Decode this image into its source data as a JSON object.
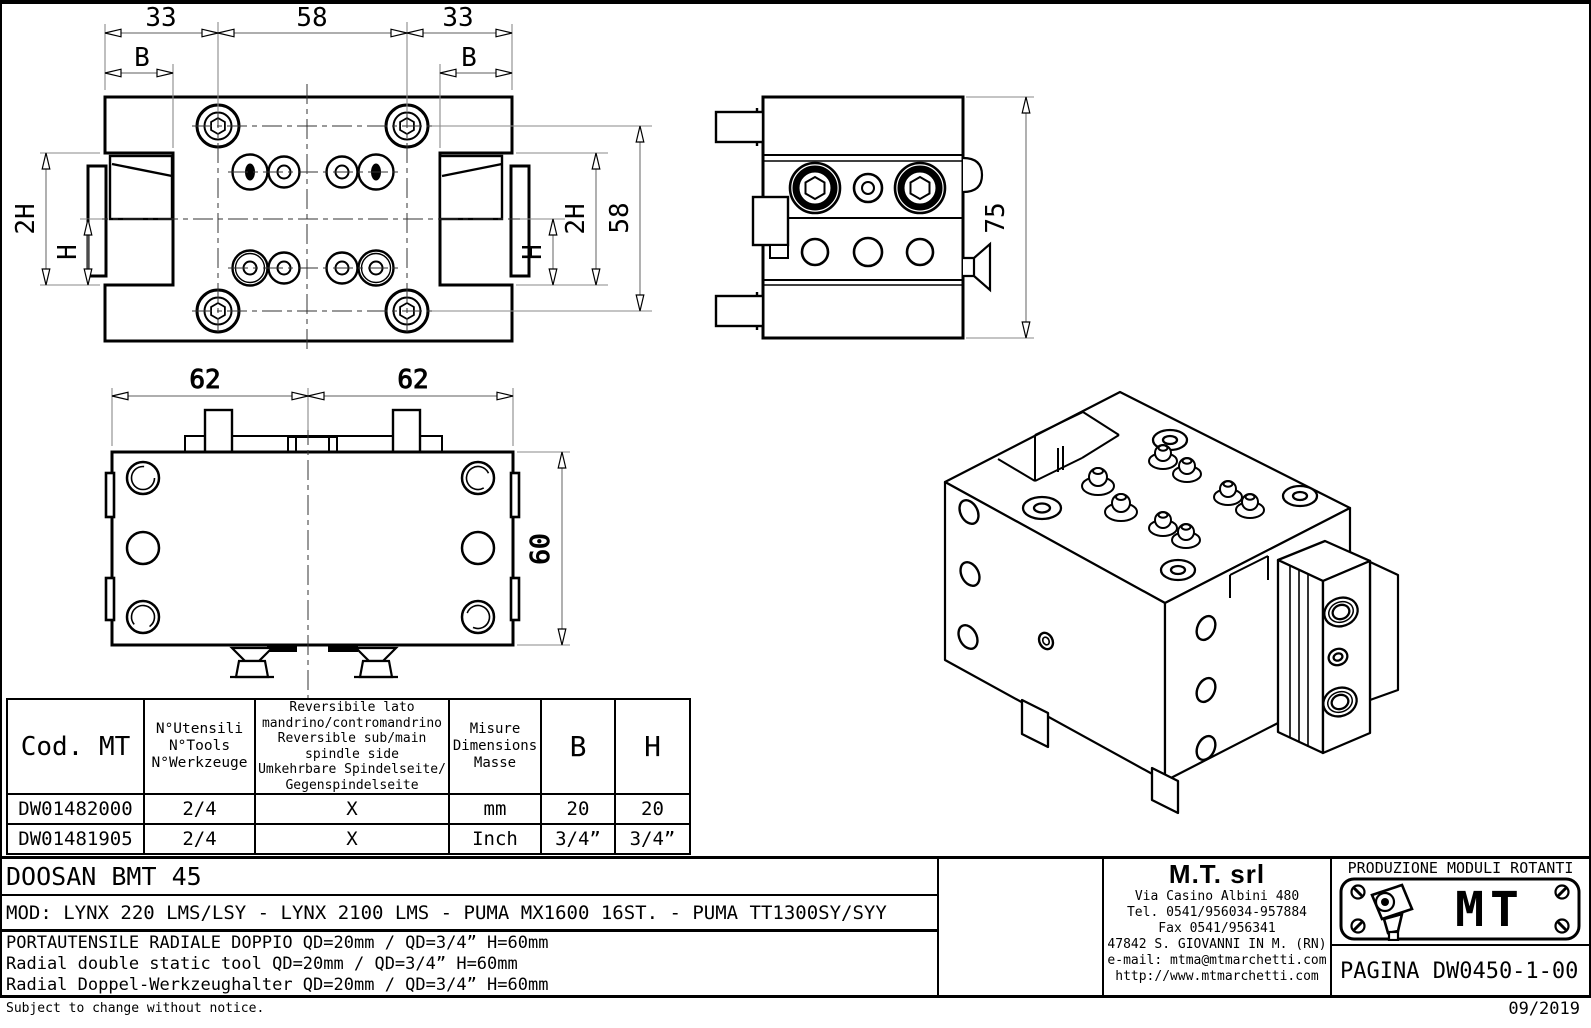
{
  "colors": {
    "line": "#000000",
    "dimension_line": "#8a8a8a",
    "background": "#ffffff"
  },
  "drawing": {
    "dims": {
      "top_33_left": "33",
      "top_58": "58",
      "top_33_right": "33",
      "b_left": "B",
      "b_right": "B",
      "left_2h": "2H",
      "left_h": "H",
      "right_h": "H",
      "right_2h": "2H",
      "right_58": "58",
      "side_75": "75",
      "front_62_left": "62",
      "front_62_right": "62",
      "front_60": "60"
    }
  },
  "table": {
    "header_cod": "Cod. MT",
    "header_tools": "N°Utensili\nN°Tools\nN°Werkzeuge",
    "header_reversible": "Reversibile lato\nmandrino/contromandrino\nReversible sub/main\nspindle side\nUmkehrbare Spindelseite/\nGegenspindelseite",
    "header_measure": "Misure\nDimensions\nMasse",
    "header_b": "B",
    "header_h": "H",
    "rows": [
      {
        "cod": "DW01482000",
        "tools": "2/4",
        "rev": "X",
        "measure": "mm",
        "b": "20",
        "h": "20"
      },
      {
        "cod": "DW01481905",
        "tools": "2/4",
        "rev": "X",
        "measure": "Inch",
        "b": "3/4”",
        "h": "3/4”"
      }
    ]
  },
  "title_block": {
    "model_name": "DOOSAN BMT 45",
    "mod_line": "MOD: LYNX 220 LMS/LSY - LYNX 2100 LMS - PUMA MX1600 16ST. - PUMA TT1300SY/SYY",
    "desc_it": "PORTAUTENSILE RADIALE DOPPIO QD=20mm / QD=3/4” H=60mm",
    "desc_en": "Radial double static tool QD=20mm / QD=3/4” H=60mm",
    "desc_de": "Radial Doppel-Werkzeughalter QD=20mm / QD=3/4” H=60mm",
    "footer_note": "Subject to change without notice.",
    "date": "09/2019"
  },
  "manufacturer": {
    "name": "M.T. srl",
    "address": "Via Casino Albini 480",
    "phone": "Tel. 0541/956034-957884",
    "fax": "Fax 0541/956341",
    "city": "47842 S. GIOVANNI IN M. (RN)",
    "email": "e-mail: mtma@mtmarchetti.com",
    "website": "http://www.mtmarchetti.com"
  },
  "logo_block": {
    "tagline": "PRODUZIONE MODULI ROTANTI",
    "logo_text": "MT",
    "page_label": "PAGINA DW0450-1-00"
  }
}
